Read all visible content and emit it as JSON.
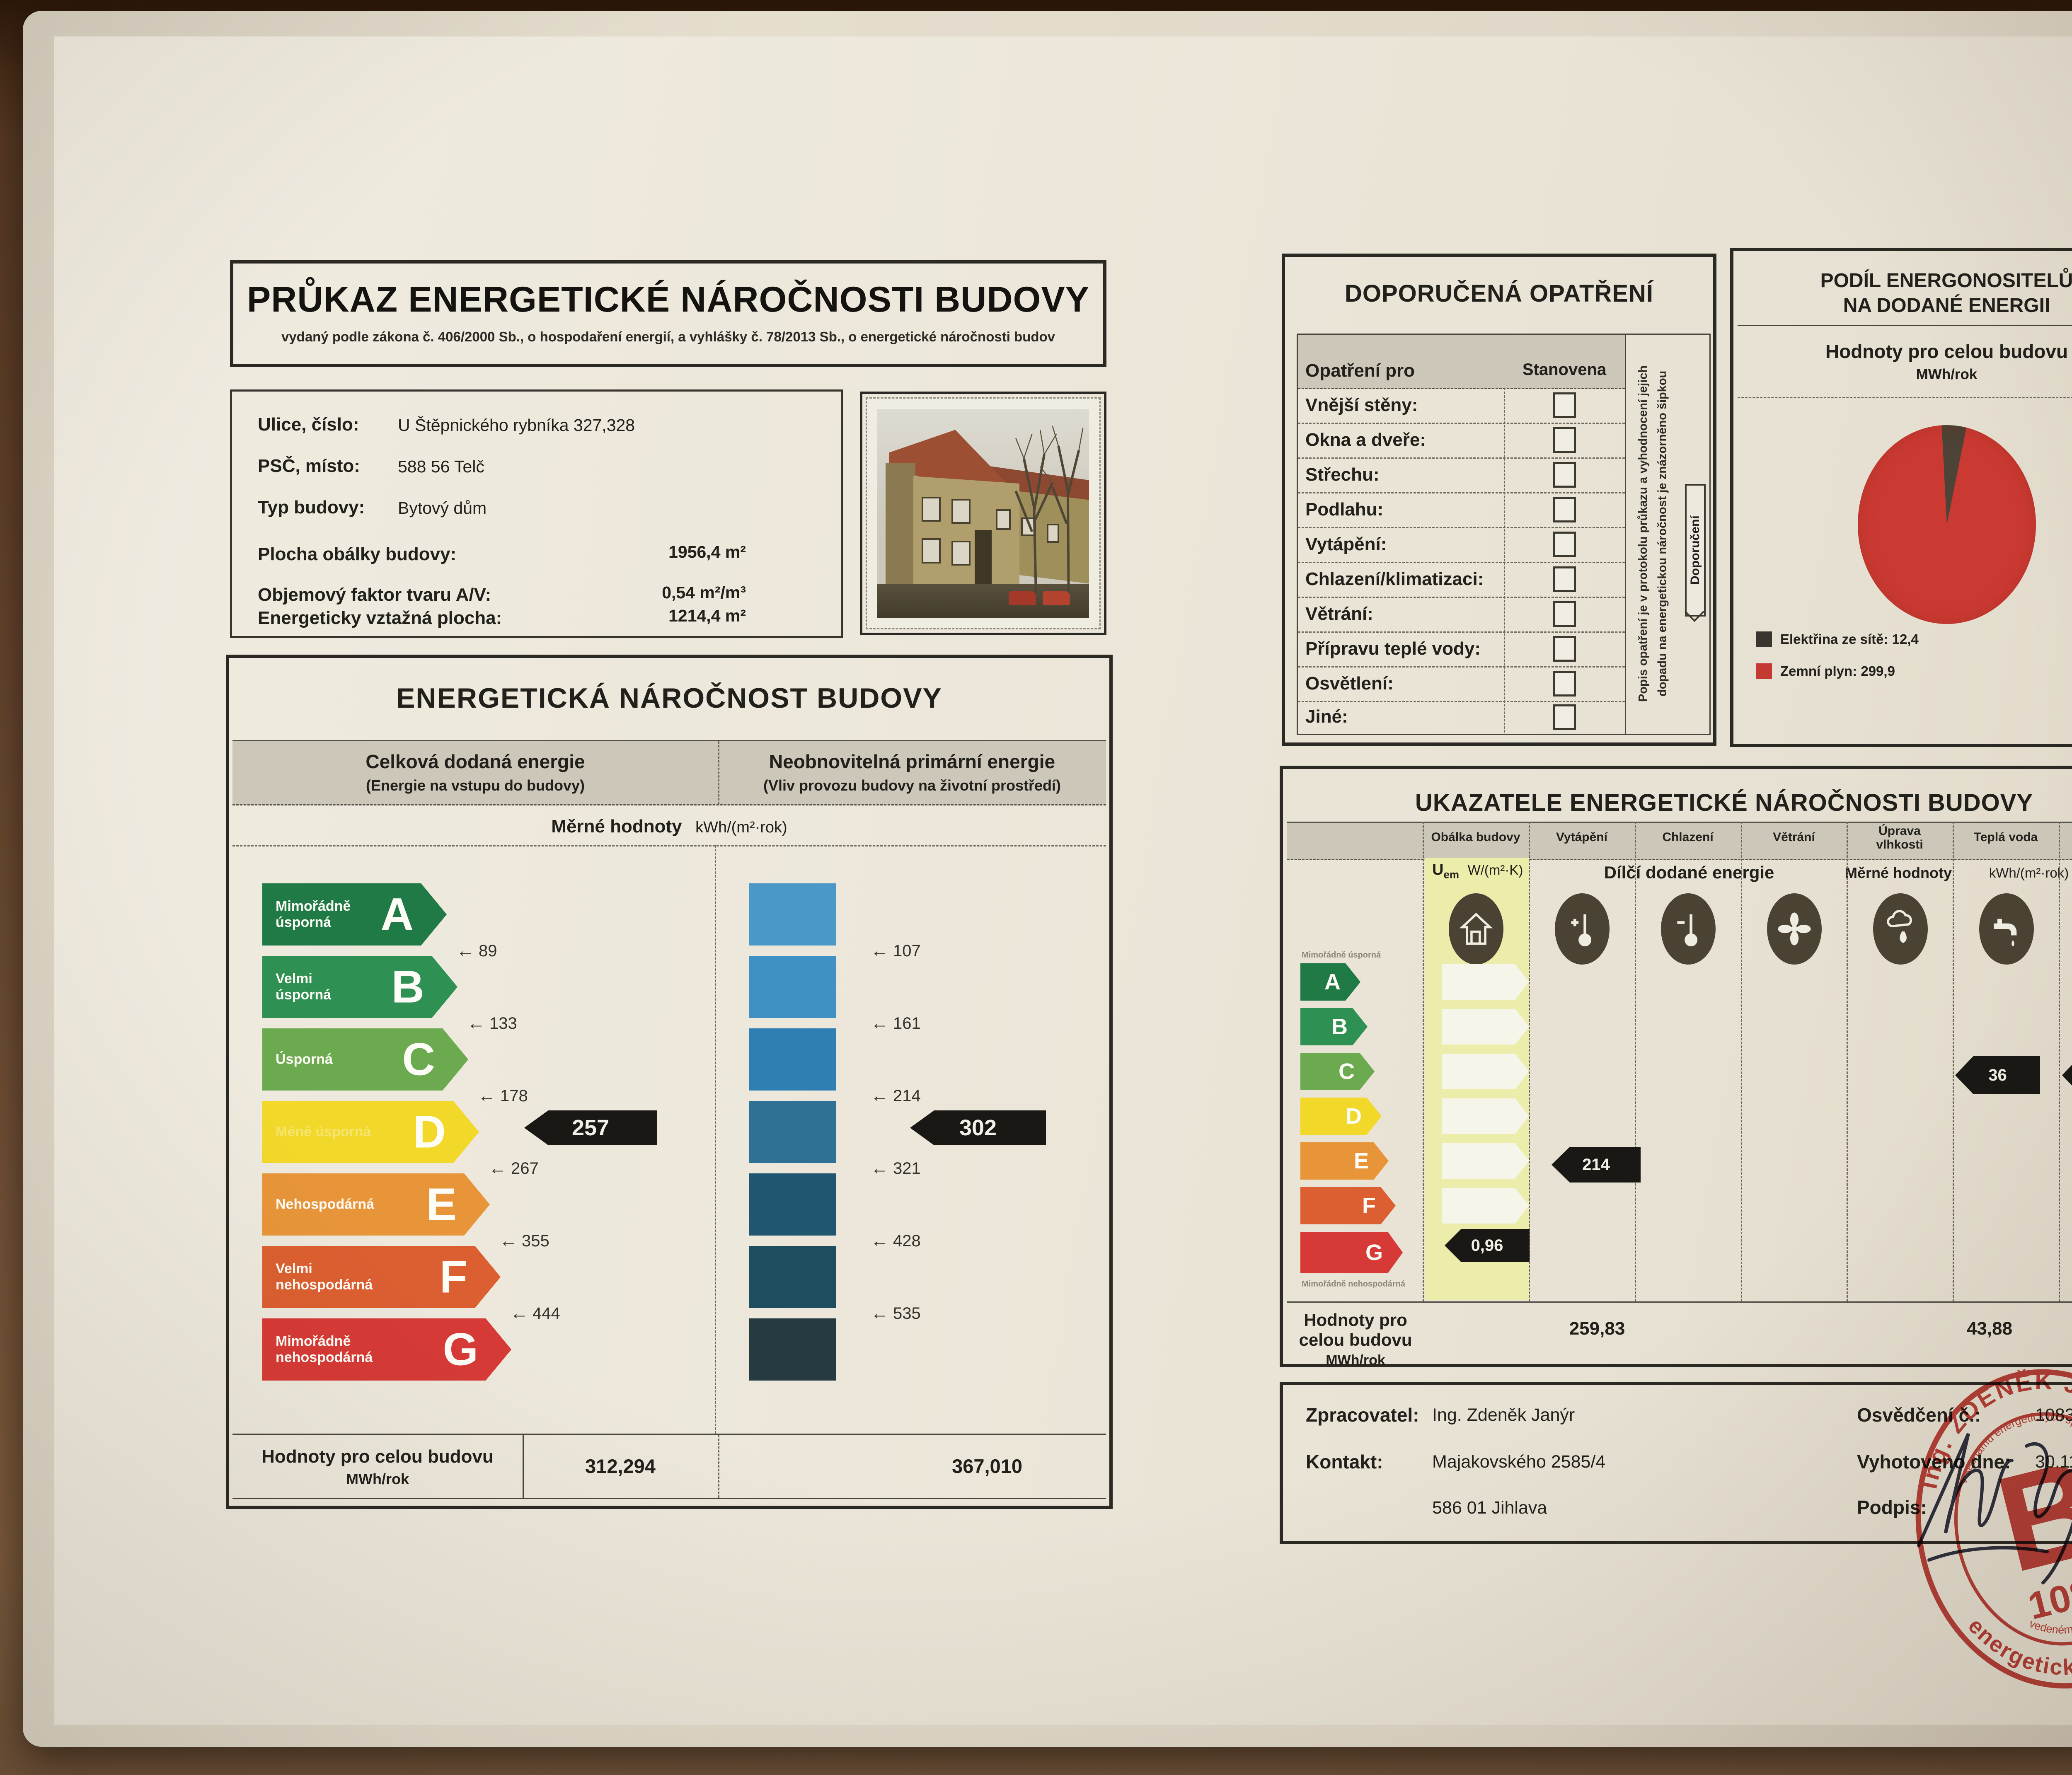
{
  "certificate": {
    "title": "PRŮKAZ ENERGETICKÉ NÁROČNOSTI BUDOVY",
    "subtitle": "vydaný podle zákona č. 406/2000 Sb., o hospodaření energií, a vyhlášky č. 78/2013 Sb., o energetické náročnosti budov"
  },
  "building": {
    "rows": [
      {
        "label": "Ulice, číslo:",
        "value": "U Štěpnického rybníka 327,328"
      },
      {
        "label": "PSČ, místo:",
        "value": "588 56  Telč"
      },
      {
        "label": "Typ budovy:",
        "value": "Bytový dům"
      },
      {
        "label": "Plocha obálky budovy:",
        "value": "1956,4 m²"
      },
      {
        "label": "Objemový faktor tvaru A/V:",
        "value": "0,54 m²/m³"
      },
      {
        "label": "Energeticky vztažná plocha:",
        "value": "1214,4 m²"
      }
    ]
  },
  "energy": {
    "title": "ENERGETICKÁ NÁROČNOST BUDOVY",
    "col_delivered": {
      "title": "Celková dodaná energie",
      "sub": "(Energie na vstupu do budovy)"
    },
    "col_primary": {
      "title": "Neobnovitelná primární energie",
      "sub": "(Vliv provozu budovy na životní prostředí)"
    },
    "units_label": "Měrné hodnoty",
    "units": "kWh/(m²·rok)",
    "classes": [
      {
        "letter": "A",
        "label": "Mimořádně\núsporná",
        "color": "#1f7a46"
      },
      {
        "letter": "B",
        "label": "Velmi\núsporná",
        "color": "#2e9153"
      },
      {
        "letter": "C",
        "label": "Úsporná",
        "color": "#6caa4f"
      },
      {
        "letter": "D",
        "label": "Méně úsporná",
        "color": "#f2d829"
      },
      {
        "letter": "E",
        "label": "Nehospodárná",
        "color": "#e8953a"
      },
      {
        "letter": "F",
        "label": "Velmi\nnehospodárná",
        "color": "#dc5f31"
      },
      {
        "letter": "G",
        "label": "Mimořádně\nnehospodárná",
        "color": "#d73a36"
      }
    ],
    "delivered_scale": [
      "89",
      "133",
      "178",
      "267",
      "355",
      "444"
    ],
    "primary_scale": [
      "107",
      "161",
      "214",
      "321",
      "428",
      "535"
    ],
    "delivered_value": "257",
    "primary_value": "302",
    "footer": {
      "label": "Hodnoty pro celou budovu",
      "units": "MWh/rok",
      "delivered": "312,294",
      "primary": "367,010"
    }
  },
  "measures": {
    "title": "DOPORUČENÁ OPATŘENÍ",
    "header": {
      "col1": "Opatření pro",
      "col2": "Stanovena"
    },
    "items": [
      "Vnější stěny:",
      "Okna a dveře:",
      "Střechu:",
      "Podlahu:",
      "Vytápění:",
      "Chlazení/klimatizaci:",
      "Větrání:",
      "Přípravu teplé vody:",
      "Osvětlení:",
      "Jiné:"
    ],
    "side_note": "Popis opatření je v protokolu průkazu a vyhodnocení jejich\ndopadu na energetickou náročnost je znázorněno šipkou",
    "side_tag": "Doporučení"
  },
  "share": {
    "title": "PODÍL ENERGONOSITELŮ\nNA DODANÉ ENERGII",
    "subtitle": "Hodnoty pro celou budovu",
    "units": "MWh/rok",
    "legend": [
      {
        "label": "Elektřina ze sítě: 12,4",
        "color": "#3a352f"
      },
      {
        "label": "Zemní plyn: 299,9",
        "color": "#c43a33"
      }
    ]
  },
  "indicators": {
    "title": "UKAZATELE ENERGETICKÉ NÁROČNOSTI BUDOVY",
    "columns": [
      {
        "label": "Obálka budovy",
        "icon": "house-icon"
      },
      {
        "label": "Vytápění",
        "icon": "thermometer-plus-icon"
      },
      {
        "label": "Chlazení",
        "icon": "thermometer-minus-icon"
      },
      {
        "label": "Větrání",
        "icon": "fan-icon"
      },
      {
        "label": "Úprava\nvlhkosti",
        "icon": "humidity-icon"
      },
      {
        "label": "Teplá voda",
        "icon": "tap-icon"
      },
      {
        "label": "Osvětlení",
        "icon": "bulb-icon"
      }
    ],
    "uem": {
      "symbol": "U",
      "sub": "em",
      "unit": "W/(m²·K)"
    },
    "subheader": {
      "partial": "Dílčí dodané energie",
      "specific": "Měrné hodnoty",
      "units": "kWh/(m²·rok)"
    },
    "scale_letters": [
      "A",
      "B",
      "C",
      "D",
      "E",
      "F",
      "G"
    ],
    "scale_note_top": "Mimořádně úsporná",
    "scale_note_bottom": "Mimořádně nehospodárná",
    "values": {
      "envelope": "0,96",
      "heating": "214",
      "hot_water": "36",
      "lighting": "7"
    },
    "footer": {
      "label": "Hodnoty pro celou budovu",
      "units": "MWh/rok",
      "heating": "259,83",
      "hot_water": "43,88",
      "lighting": "8,58"
    }
  },
  "issuer": {
    "processor_label": "Zpracovatel:",
    "processor": "Ing. Zdeněk Janýr",
    "contact_label": "Kontakt:",
    "contact_line1": "Majakovského 2585/4",
    "contact_line2": "586 01  Jihlava",
    "certificate_no_label": "Osvědčení č.:",
    "certificate_no": "1083",
    "issued_label": "Vyhotoveno dne:",
    "issued": "30.11.2015",
    "signature_label": "Podpis:"
  },
  "stamp": {
    "arc_top": "Ing. ZDENĚK JANÝR",
    "arc_bottom": "energetický specialista",
    "arc_inner_top": "v seznamu energetických specialistů",
    "arc_inner_bottom": "vedeném pod číslem",
    "monogram": "B",
    "number": "1083",
    "color": "#c0332d"
  },
  "chart_data": [
    {
      "type": "pie",
      "title": "PODÍL ENERGONOSITELŮ NA DODANÉ ENERGII",
      "unit": "MWh/rok",
      "labels": [
        "Elektřina ze sítě",
        "Zemní plyn"
      ],
      "values": [
        12.4,
        299.9
      ],
      "colors": [
        "#3a352f",
        "#c43a33"
      ],
      "legend_position": "bottom-left"
    },
    {
      "type": "bar",
      "title": "Celková dodaná energie (Energie na vstupu do budovy) – Měrné hodnoty kWh/(m²·rok)",
      "categories": [
        "A",
        "B",
        "C",
        "D",
        "E",
        "F",
        "G"
      ],
      "class_boundaries_kwh_m2rok": [
        89,
        133,
        178,
        267,
        355,
        444
      ],
      "value_kwh_m2rok": 257,
      "value_class": "D",
      "building_total_MWh_rok": 312.294
    },
    {
      "type": "bar",
      "title": "Neobnovitelná primární energie (Vliv provozu budovy na životní prostředí) – Měrné hodnoty kWh/(m²·rok)",
      "scale_kwh_m2rok": [
        107,
        161,
        214,
        321,
        428,
        535
      ],
      "value_kwh_m2rok": 302,
      "building_total_MWh_rok": 367.01
    },
    {
      "type": "table",
      "title": "UKAZATELE ENERGETICKÉ NÁROČNOSTI BUDOVY",
      "rows": [
        {
          "indicator": "Obálka budovy Uem",
          "value": 0.96,
          "unit": "W/(m²·K)",
          "class_row": "G"
        },
        {
          "indicator": "Vytápění – dílčí dodaná energie",
          "value": 214,
          "unit": "kWh/(m²·rok)",
          "class_row": "E",
          "building_total_MWh_rok": 259.83
        },
        {
          "indicator": "Teplá voda – dílčí dodaná energie",
          "value": 36,
          "unit": "kWh/(m²·rok)",
          "class_row": "C",
          "building_total_MWh_rok": 43.88
        },
        {
          "indicator": "Osvětlení – dílčí dodaná energie",
          "value": 7,
          "unit": "kWh/(m²·rok)",
          "class_row": "C",
          "building_total_MWh_rok": 8.58
        }
      ]
    }
  ]
}
